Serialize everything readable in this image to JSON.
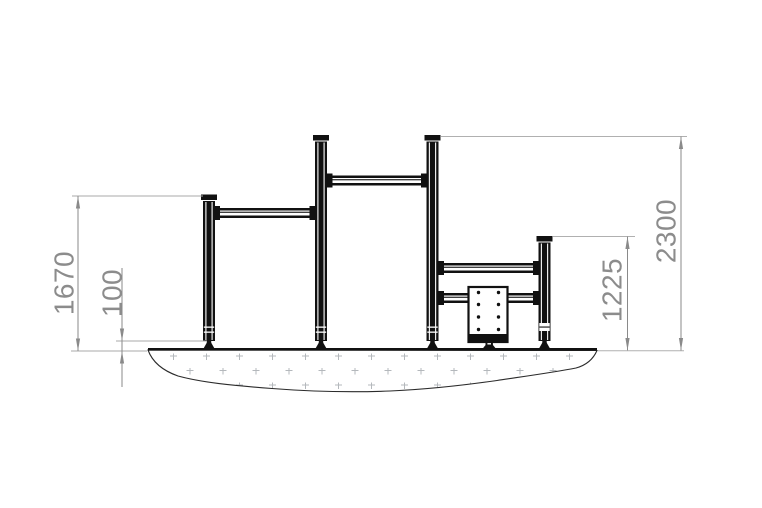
{
  "drawing": {
    "type": "technical-elevation-side-view",
    "subject": "outdoor pull-up bar unit on ground section",
    "dimensions": {
      "left_bar_height": {
        "label": "1670"
      },
      "anchor_depth": {
        "label": "100"
      },
      "right_bar_height": {
        "label": "1225"
      },
      "total_height": {
        "label": "2300"
      }
    },
    "colors": {
      "structure": "#111111",
      "dimension_line": "#8a8a8a",
      "dimension_text": "#8c8c8c",
      "extension_line": "#a9a9a9",
      "ground_outline": "#2b2b2b",
      "ground_texture": "#b4b8bc",
      "background": "#ffffff"
    }
  }
}
